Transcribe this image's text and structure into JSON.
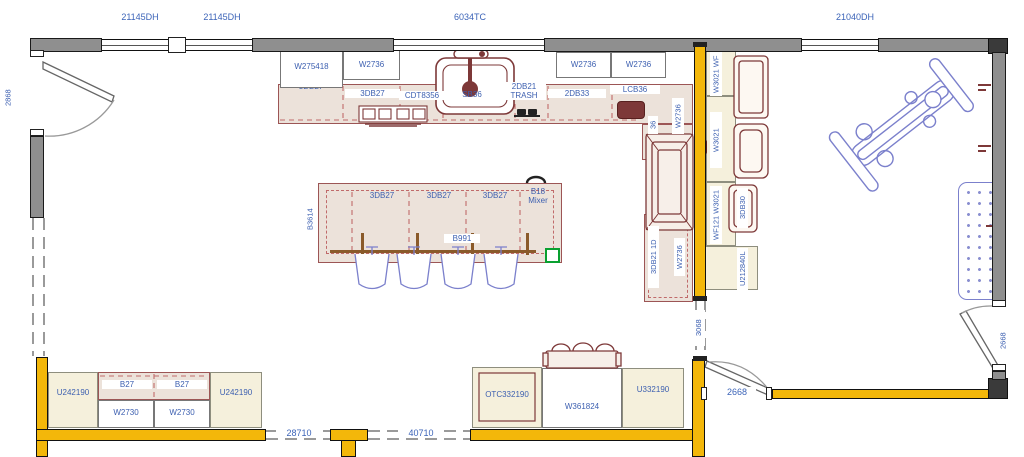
{
  "colors": {
    "wall_gray": "#8f8f8f",
    "wall_yellow": "#f3b70a",
    "cabinet_cream": "#f5f0dc",
    "counter_beige": "#ece2da",
    "appliance_maroon": "#7d3838",
    "label_blue": "#3c5fb0",
    "furniture_blue": "#7b80cc",
    "selection_green": "#09a030"
  },
  "dimensions": {
    "window_left_1": "21145DH",
    "window_left_2": "21145DH",
    "window_center": "6034TC",
    "window_right": "21040DH",
    "door_left": "2868",
    "opening_center": "3068",
    "door_bottom_center": "2668",
    "door_right": "2668",
    "opening_bottom_left": "28710",
    "opening_bottom_right": "40710"
  },
  "top_run": {
    "wall_cabinets": [
      "W275418",
      "W2736",
      "W2736",
      "W2736"
    ],
    "base_cabinets": [
      "3DB27",
      "3DB27",
      "CDT8356",
      "SB36",
      "2DB21 TRASH",
      "2DB33",
      "LCB36"
    ]
  },
  "east_run": {
    "kitchen_side": [
      "W2736",
      "36",
      "3DB21 1D",
      "W2736"
    ],
    "room_side": [
      "W3021 WF",
      "W3021",
      "WF121 W3021",
      "3DB30",
      "U212840L"
    ]
  },
  "island": {
    "side_label": "B3614",
    "top_row": [
      "3DB27",
      "3DB27",
      "3DB27",
      "B18 Mixer"
    ],
    "front_label": "B991"
  },
  "bottom_left_run": {
    "tall_left": "U242190",
    "base_cabinets": [
      "B27",
      "B27"
    ],
    "wall_cabinets": [
      "W2730",
      "W2730"
    ],
    "tall_right": "U242190"
  },
  "bottom_center_run": {
    "oven_cabinet": "OTC332190",
    "wall_cabinet": "W361824",
    "tall_cabinet": "U332190"
  }
}
